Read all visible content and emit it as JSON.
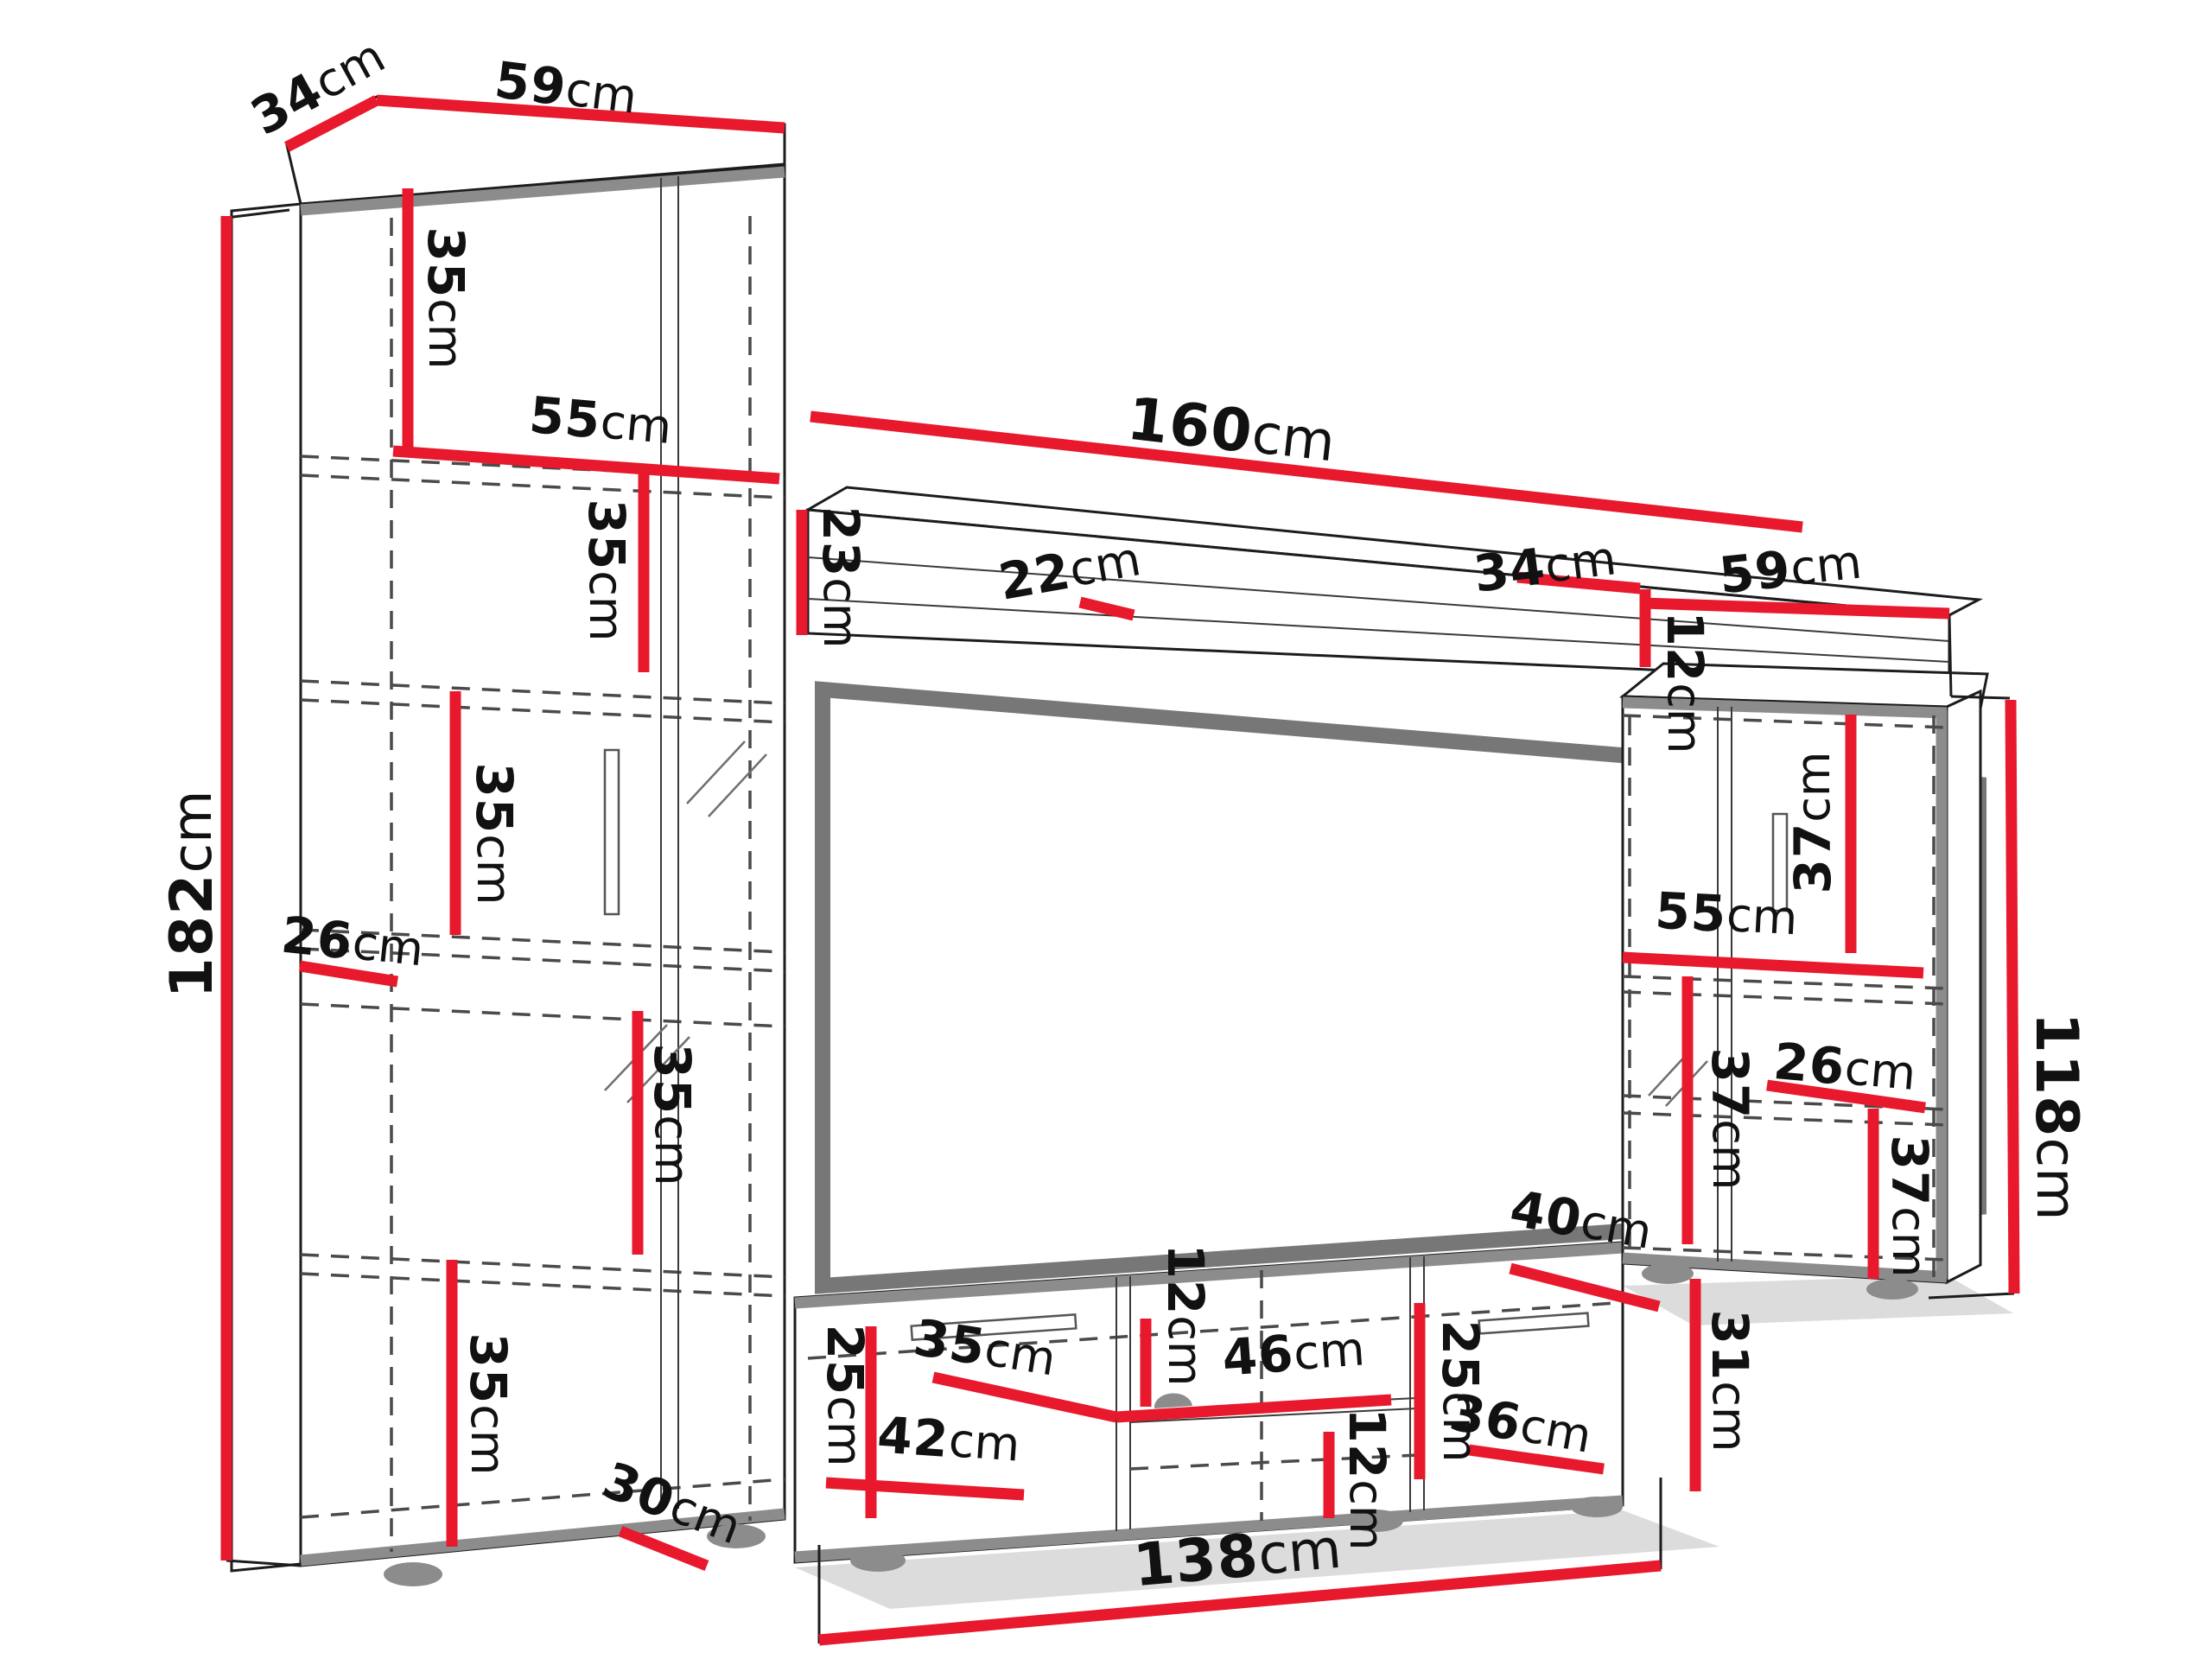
{
  "diagram": {
    "type": "furniture-dimension-drawing",
    "subject": "TV wall unit with tall display cabinet, wall shelf, TV panel, lowboard and side cabinet",
    "unit": "cm",
    "colors": {
      "dimension_line": "#e8192c",
      "outline": "#1c1c1c",
      "panel_frame": "#777777",
      "edge_band": "#8c8c8c"
    }
  },
  "dims": {
    "left_top_depth": {
      "v": "34",
      "u": "cm"
    },
    "left_top_width": {
      "v": "59",
      "u": "cm"
    },
    "left_sec1_height": {
      "v": "35",
      "u": "cm"
    },
    "left_inner_width": {
      "v": "55",
      "u": "cm"
    },
    "left_sec2_height": {
      "v": "35",
      "u": "cm"
    },
    "left_sec3_height": {
      "v": "35",
      "u": "cm"
    },
    "left_sec4_height": {
      "v": "26",
      "u": "cm"
    },
    "left_sec5_height": {
      "v": "35",
      "u": "cm"
    },
    "left_sec6_height": {
      "v": "35",
      "u": "cm"
    },
    "left_bottom_depth": {
      "v": "30",
      "u": "cm"
    },
    "left_height": {
      "v": "182",
      "u": "cm"
    },
    "shelf_width": {
      "v": "160",
      "u": "cm"
    },
    "shelf_height": {
      "v": "23",
      "u": "cm"
    },
    "shelf_depth": {
      "v": "22",
      "u": "cm"
    },
    "bridge_depth": {
      "v": "34",
      "u": "cm"
    },
    "right_top_width": {
      "v": "59",
      "u": "cm"
    },
    "bridge_height": {
      "v": "12",
      "u": "cm"
    },
    "right_sec1_height": {
      "v": "37",
      "u": "cm"
    },
    "right_inner_width": {
      "v": "55",
      "u": "cm"
    },
    "right_sec2_height": {
      "v": "37",
      "u": "cm"
    },
    "right_shelf_gap": {
      "v": "26",
      "u": "cm"
    },
    "right_height": {
      "v": "118",
      "u": "cm"
    },
    "stand_top_depth": {
      "v": "40",
      "u": "cm"
    },
    "right_sec3_height": {
      "v": "37",
      "u": "cm"
    },
    "right_door_height": {
      "v": "31",
      "u": "cm"
    },
    "stand_left_height": {
      "v": "25",
      "u": "cm"
    },
    "stand_shelf_width": {
      "v": "35",
      "u": "cm"
    },
    "stand_shelf_gap": {
      "v": "12",
      "u": "cm"
    },
    "stand_niche_width": {
      "v": "46",
      "u": "cm"
    },
    "stand_drawer_width": {
      "v": "42",
      "u": "cm"
    },
    "stand_niche_gap": {
      "v": "12",
      "u": "cm"
    },
    "stand_right_height": {
      "v": "25",
      "u": "cm"
    },
    "stand_door_width": {
      "v": "36",
      "u": "cm"
    },
    "stand_width": {
      "v": "138",
      "u": "cm"
    }
  }
}
